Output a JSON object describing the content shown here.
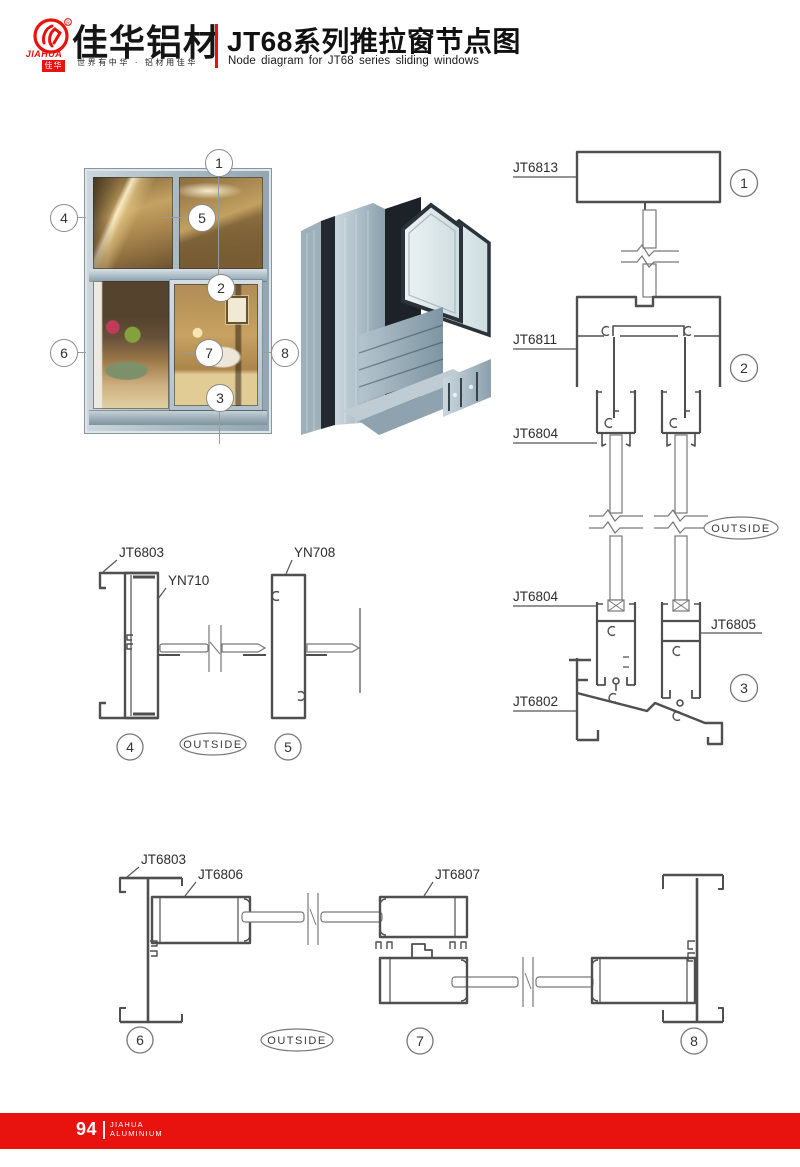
{
  "header": {
    "logo": {
      "name_en": "JIAHUA",
      "seal": "佳华"
    },
    "brand_cn": "佳华铝材",
    "slogan": "世界有中华 · 铝材用佳华",
    "title_cn": "JT68系列推拉窗节点图",
    "title_en": "Node diagram for JT68 series sliding windows"
  },
  "profiles": {
    "jt6813": "JT6813",
    "jt6811": "JT6811",
    "jt6804": "JT6804",
    "jt6805": "JT6805",
    "jt6802": "JT6802",
    "jt6803": "JT6803",
    "yn710": "YN710",
    "yn708": "YN708",
    "jt6806": "JT6806",
    "jt6807": "JT6807"
  },
  "outside_label": "OUTSIDE",
  "callouts": {
    "n1": "1",
    "n2": "2",
    "n3": "3",
    "n4": "4",
    "n5": "5",
    "n6": "6",
    "n7": "7",
    "n8": "8"
  },
  "footer": {
    "page_number": "94",
    "brand_line1": "JIAHUA",
    "brand_line2": "ALUMINIUM"
  },
  "colors": {
    "accent_red": "#e8120e",
    "line_dark": "#4f4f4f",
    "line_light": "#777777",
    "aluminium": "#b6c3cc"
  }
}
